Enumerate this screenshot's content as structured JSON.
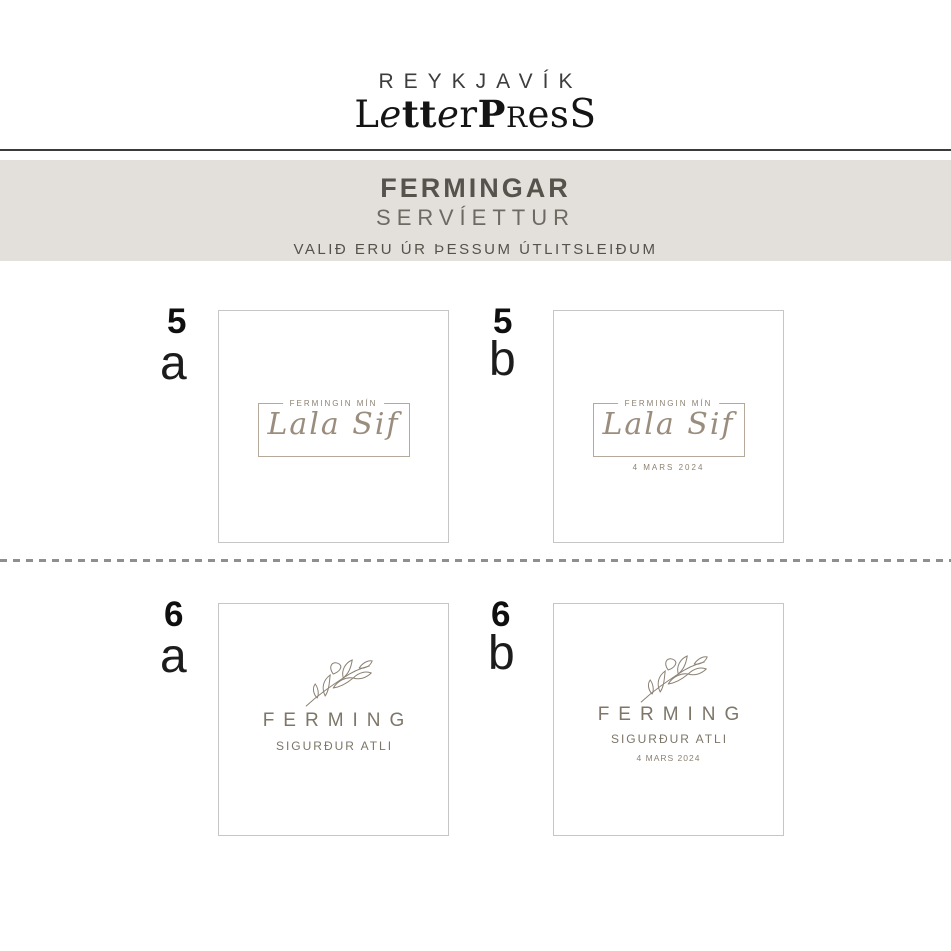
{
  "logo": {
    "line1": "REYKJAVÍK",
    "line2_parts": [
      {
        "t": "L"
      },
      {
        "t": "e"
      },
      {
        "t": "tt"
      },
      {
        "t": "e"
      },
      {
        "t": "r"
      },
      {
        "t": "P"
      },
      {
        "t": "R"
      },
      {
        "t": "es"
      },
      {
        "t": "S"
      }
    ]
  },
  "banner": {
    "title": "FERMINGAR",
    "subtitle": "SERVÍETTUR",
    "note": "VALIÐ ERU ÚR ÞESSUM ÚTLITSLEIÐUM"
  },
  "cards": [
    {
      "number": "5",
      "variant": "a",
      "type": "frame",
      "header": "FERMINGIN MÍN",
      "name": "Lala Sif"
    },
    {
      "number": "5",
      "variant": "b",
      "type": "frame",
      "header": "FERMINGIN MÍN",
      "name": "Lala Sif",
      "date": "4 MARS 2024"
    },
    {
      "number": "6",
      "variant": "a",
      "type": "botanical",
      "title": "FERMING",
      "name": "SIGURÐUR ATLI"
    },
    {
      "number": "6",
      "variant": "b",
      "type": "botanical",
      "title": "FERMING",
      "name": "SIGURÐUR ATLI",
      "date": "4 MARS 2024"
    }
  ],
  "icons": {
    "sprig": "branch-sprig-icon"
  },
  "colors": {
    "band_bg": "#e3dfda",
    "heading_ink": "#56524c",
    "accent_taupe": "#7d7669",
    "frame_border": "#b5a99b",
    "script_ink": "#9a8d7e",
    "label_ink": "#8d8173",
    "card_border": "#c6c6c6",
    "dash": "#8f8f8f",
    "rule": "#3b3b3b",
    "logo_ink": "#141414"
  }
}
